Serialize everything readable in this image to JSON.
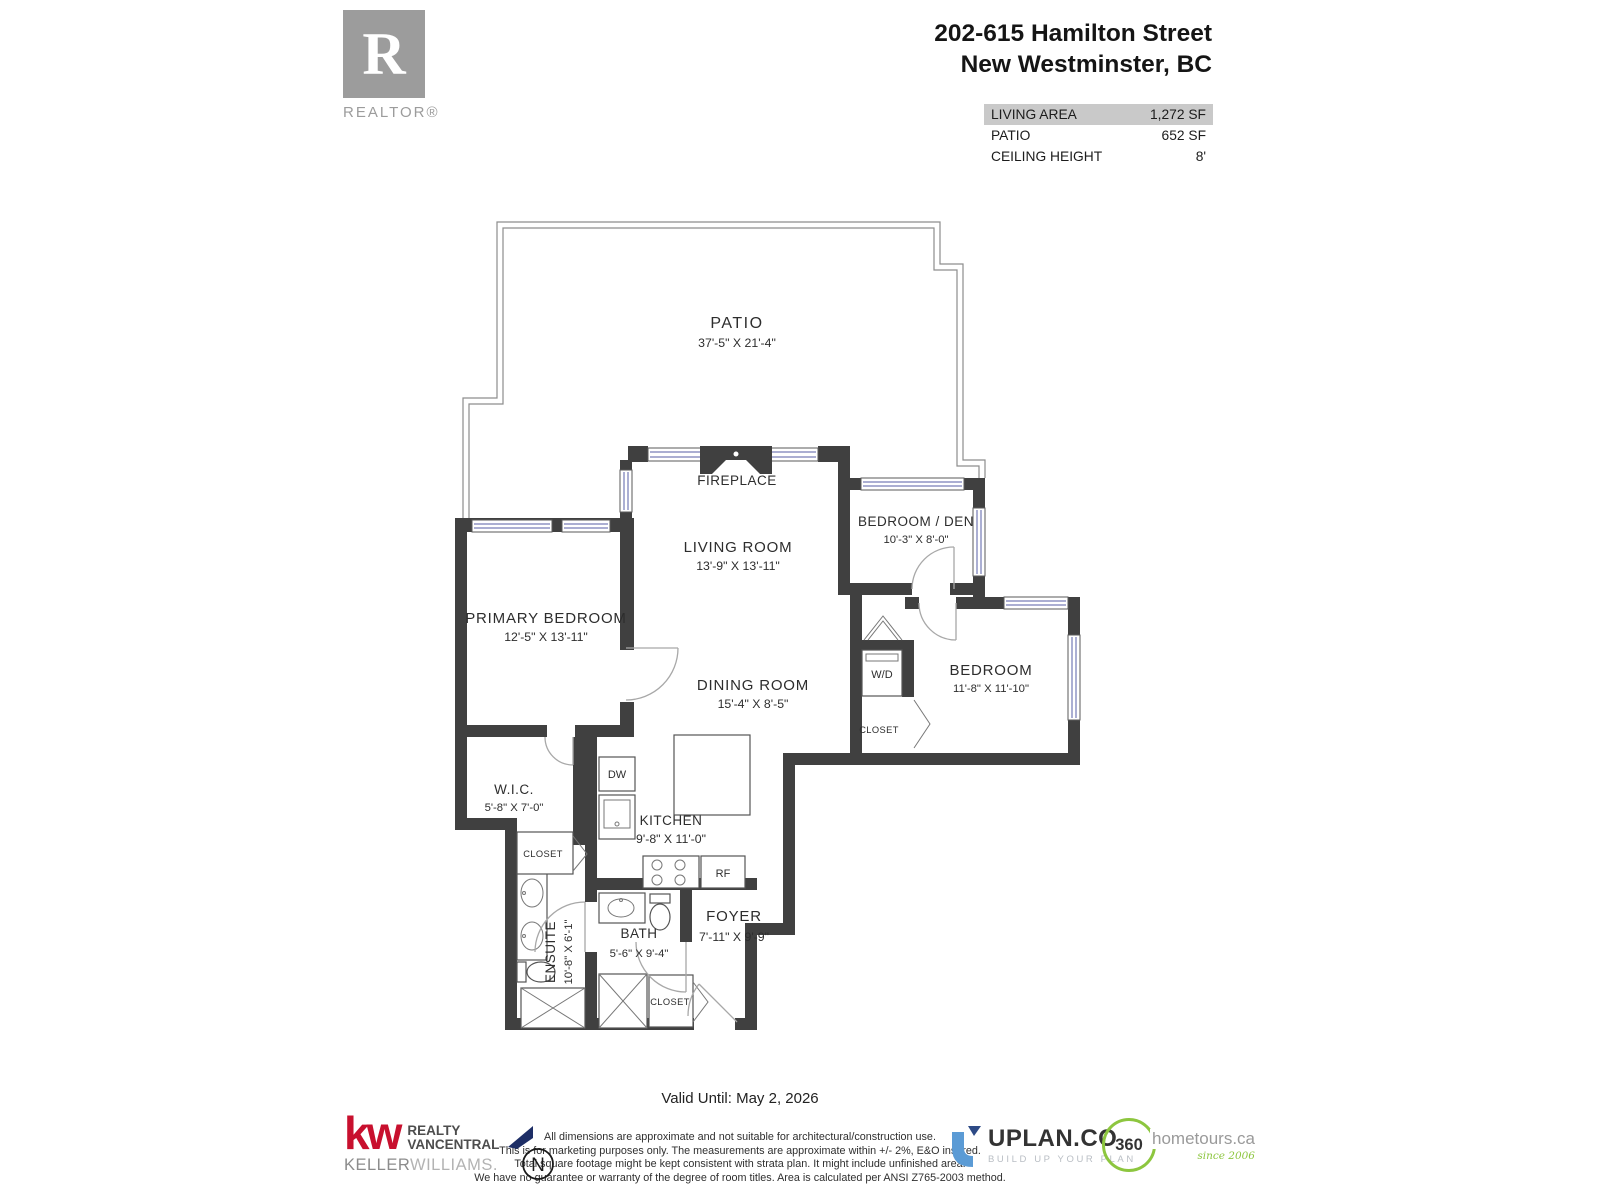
{
  "header": {
    "logo": {
      "letter": "R",
      "word": "REALTOR®"
    },
    "address_line1": "202-615 Hamilton Street",
    "address_line2": "New Westminster, BC",
    "stats": [
      {
        "label": "LIVING AREA",
        "value": "1,272 SF",
        "highlight": true
      },
      {
        "label": "PATIO",
        "value": "652 SF",
        "highlight": false
      },
      {
        "label": "CEILING HEIGHT",
        "value": "8'",
        "highlight": false
      }
    ]
  },
  "floorplan": {
    "patio": {
      "name": "PATIO",
      "dims": "37'-5\"  X  21'-4\""
    },
    "living_room": {
      "name": "LIVING ROOM",
      "dims": "13'-9\"  X 13'-11\""
    },
    "dining_room": {
      "name": "DINING ROOM",
      "dims": "15'-4\"  X   8'-5\""
    },
    "primary_bedroom": {
      "name": "PRIMARY BEDROOM",
      "dims": "12'-5\"  X 13'-11\""
    },
    "bedroom_den": {
      "name": "BEDROOM / DEN",
      "dims": "10'-3\"  X   8'-0\""
    },
    "bedroom": {
      "name": "BEDROOM",
      "dims": "11'-8\"  X 11'-10\""
    },
    "wic": {
      "name": "W.I.C.",
      "dims": "5'-8\"   X   7'-0\""
    },
    "ensuite": {
      "name": "ENSUITE",
      "dims": "10'-8\"  X  6'-1\""
    },
    "bath": {
      "name": "BATH",
      "dims": "5'-6\"   X   9'-4\""
    },
    "kitchen": {
      "name": "KITCHEN",
      "dims": "9'-8\"   X  11'-0\""
    },
    "foyer": {
      "name": "FOYER",
      "dims": "7'-11\" X  9'-9\""
    },
    "fireplace_label": "FIREPLACE",
    "wd_label": "W/D",
    "dw_label": "DW",
    "rf_label": "RF",
    "closet_label": "CLOSET"
  },
  "footer": {
    "valid_until": "Valid Until: May 2, 2026",
    "disclaimer_lines": [
      "All dimensions are approximate and not suitable for architectural/construction use.",
      "This is for marketing purposes only. The measurements are approximate within +/- 2%, E&O insured.",
      "Total square footage might be kept consistent with strata plan. It might include unfinished area.",
      "We have no guarantee or warranty of the degree of room titles. Area is calculated per ANSI Z765-2003 method."
    ],
    "kw": {
      "mark": "kw",
      "line1": "REALTY",
      "line2": "VANCENTRAL",
      "keller": "KELLER",
      "williams": "WILLIAMS."
    },
    "north": {
      "label": "N"
    },
    "uplan": {
      "name": "UPLAN.CO",
      "tagline": "BUILD UP YOUR PLAN"
    },
    "tours360": {
      "number": "360",
      "name": "hometours.ca",
      "since": "since 2006"
    }
  },
  "colors": {
    "wall": "#404040",
    "window": "#8f94c4",
    "stats_highlight": "#c9c9c9",
    "kw_red": "#c8102e",
    "uplan_blue": "#4f8fd0",
    "tours_green": "#8dc63f",
    "north_navy": "#1d2e66",
    "realtor_gray": "#9c9c9c"
  }
}
